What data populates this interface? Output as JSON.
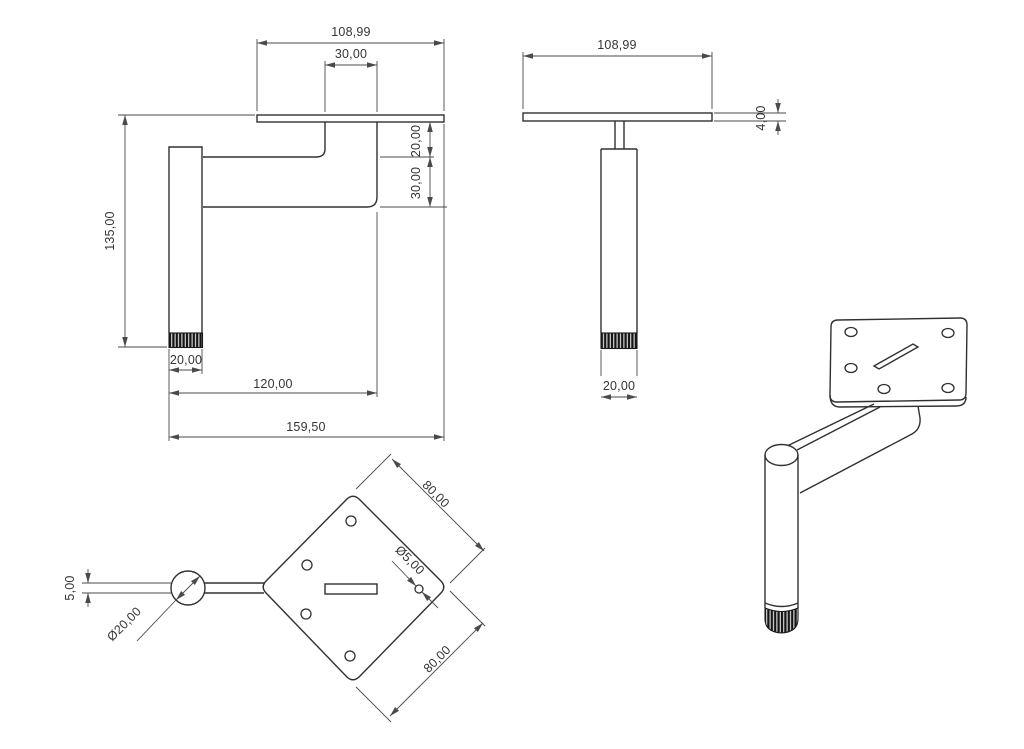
{
  "drawing": {
    "front_view": {
      "dims": {
        "plate_width": "108,99",
        "stem_width": "30,00",
        "plate_to_arm": "20,00",
        "arm_height": "30,00",
        "overall_height": "135,00",
        "foot_width": "20,00",
        "leg_to_stem_length": "120,00",
        "overall_width": "159,50"
      }
    },
    "side_view": {
      "dims": {
        "plate_width": "108,99",
        "plate_thickness": "4,00",
        "foot_width": "20,00"
      }
    },
    "top_view": {
      "dims": {
        "plate_edge_upper": "80,00",
        "plate_edge_lower": "80,00",
        "hole_diameter": "Ø5,00",
        "arm_width": "5,00",
        "tube_diameter": "Ø20,00"
      }
    },
    "colors": {
      "background": "#ffffff",
      "object_line": "#303030",
      "dimension_line": "#4a4a4a",
      "dimension_text": "#353535",
      "foot_knurl": "#141414"
    }
  }
}
